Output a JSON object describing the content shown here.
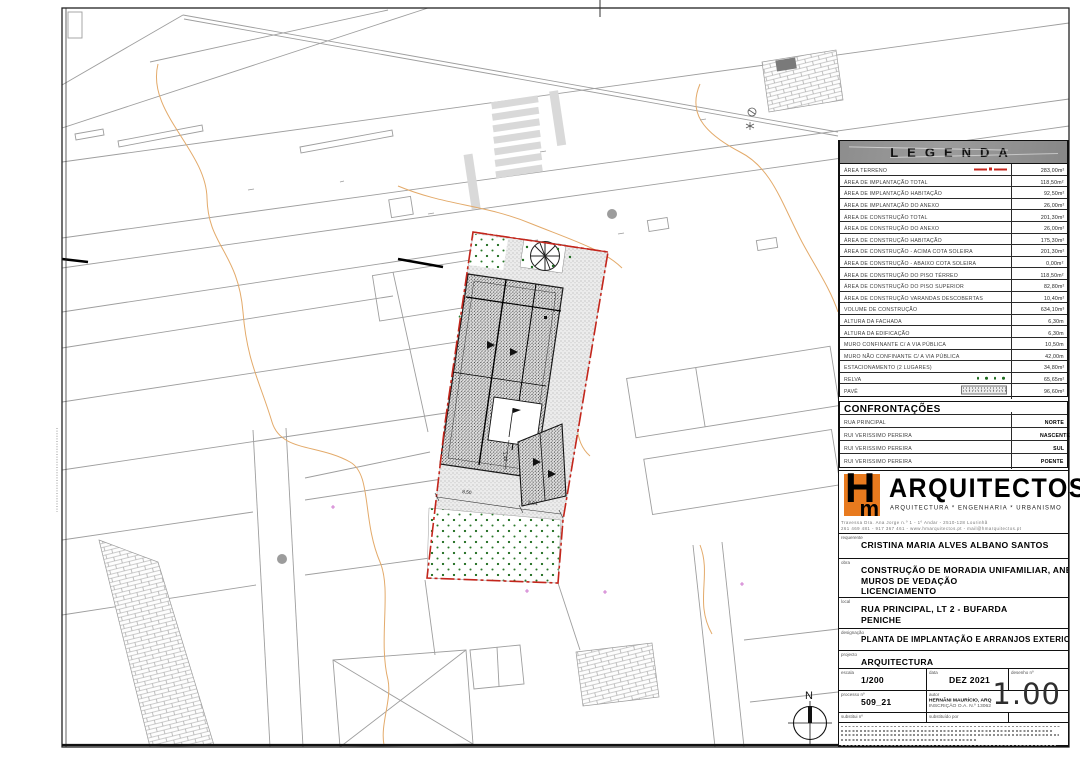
{
  "colors": {
    "red": "#c3261c",
    "green": "#1e6b1e",
    "orange": "#e87a1e"
  },
  "legend": {
    "title": "LEGENDA",
    "rows": [
      {
        "label": "ÁREA TERRENO",
        "value": "283,00m²",
        "symbol": "sym-boundary"
      },
      {
        "label": "ÁREA DE IMPLANTAÇÃO TOTAL",
        "value": "118,50m²",
        "symbol": null
      },
      {
        "label": "ÁREA DE IMPLANTAÇÃO HABITAÇÃO",
        "value": "92,50m²",
        "symbol": null
      },
      {
        "label": "ÁREA DE IMPLANTAÇÃO DO ANEXO",
        "value": "26,00m²",
        "symbol": null
      },
      {
        "label": "ÁREA DE CONSTRUÇÃO TOTAL",
        "value": "201,30m²",
        "symbol": null
      },
      {
        "label": "ÁREA DE CONSTRUÇÃO DO ANEXO",
        "value": "26,00m²",
        "symbol": null
      },
      {
        "label": "ÁREA DE CONSTRUÇÃO HABITAÇÃO",
        "value": "175,30m²",
        "symbol": null
      },
      {
        "label": "ÁREA DE CONSTRUÇÃO - ACIMA COTA SOLEIRA",
        "value": "201,30m²",
        "symbol": null
      },
      {
        "label": "ÁREA DE CONSTRUÇÃO - ABAIXO COTA SOLEIRA",
        "value": "0,00m²",
        "symbol": null
      },
      {
        "label": "ÁREA DE CONSTRUÇÃO DO PISO TÉRREO",
        "value": "118,50m²",
        "symbol": null
      },
      {
        "label": "ÁREA DE CONSTRUÇÃO DO PISO SUPERIOR",
        "value": "82,80m²",
        "symbol": null
      },
      {
        "label": "ÁREA DE CONSTRUÇÃO VARANDAS DESCOBERTAS",
        "value": "10,40m²",
        "symbol": null
      },
      {
        "label": "VOLUME DE CONSTRUÇÃO",
        "value": "634,10m³",
        "symbol": null
      },
      {
        "label": "ALTURA DA FACHADA",
        "value": "6,30m",
        "symbol": null
      },
      {
        "label": "ALTURA DA EDIFICAÇÃO",
        "value": "6,30m",
        "symbol": null
      },
      {
        "label": "MURO CONFINANTE C/ A VIA PÚBLICA",
        "value": "10,50m",
        "symbol": null
      },
      {
        "label": "MURO NÃO CONFINANTE C/ A VIA PÚBLICA",
        "value": "42,00m",
        "symbol": null
      },
      {
        "label": "ESTACIONAMENTO (2 LUGARES)",
        "value": "34,80m²",
        "symbol": null
      },
      {
        "label": "RELVA",
        "value": "65,65m²",
        "symbol": "sym-relva"
      },
      {
        "label": "PAVÊ",
        "value": "96,60m²",
        "symbol": "sym-pave"
      }
    ]
  },
  "confrontacoes": {
    "title": "CONFRONTAÇÕES",
    "rows": [
      {
        "label": "RUA PRINCIPAL",
        "value": "NORTE"
      },
      {
        "label": "RUI VERISSIMO PEREIRA",
        "value": "NASCENTE"
      },
      {
        "label": "RUI VERISSIMO PEREIRA",
        "value": "SUL"
      },
      {
        "label": "RUI VERISSIMO PEREIRA",
        "value": "POENTE"
      }
    ]
  },
  "firm": {
    "logo_h": "H",
    "logo_m": "m",
    "name": "ARQUITECTOS",
    "tagline": "ARQUITECTURA * ENGENHARIA * URBANISMO",
    "address_line1": "Travessa Dra. Ana Jorge n.º 1 - 1º Andar - 2510-128 Lourinhã",
    "address_line2": "261 469 481 - 917 367 461 - www.hmarquitectos.pt - mail@hmarquitectos.pt"
  },
  "titleblock": {
    "requerente_label": "requerente",
    "requerente": "CRISTINA MARIA ALVES ALBANO SANTOS",
    "obra_label": "obra",
    "obra_line1": "CONSTRUÇÃO DE MORADIA UNIFAMILIAR, ANEXO E",
    "obra_line2": "MUROS DE VEDAÇÃO",
    "obra_line3": "LICENCIAMENTO",
    "local_label": "local",
    "local_line1": "RUA PRINCIPAL, LT 2 - BUFARDA",
    "local_line2": "PENICHE",
    "designacao_label": "designação",
    "designacao": "PLANTA DE IMPLANTAÇÃO E ARRANJOS EXTERIORES",
    "projecto_label": "projecto",
    "projecto": "ARQUITECTURA",
    "escala_label": "escala",
    "escala": "1/200",
    "data_label": "data",
    "data": "DEZ 2021",
    "desenho_label": "desenho nº",
    "desenho_numero": "1.00",
    "processo_label": "processo nº",
    "processo": "509_21",
    "autor_label": "autor",
    "autor_line1": "HERNÂNI MAURÍCIO, ARQ",
    "autor_line2": "INSCRIÇÃO O.A. N.º 13062",
    "substitui_label": "substitui nº",
    "substituido_label": "substituído por"
  },
  "plan": {
    "north_label": "N",
    "dimensions": {
      "d1": "8,50",
      "d2": "5,04",
      "d3": "1,48"
    }
  }
}
